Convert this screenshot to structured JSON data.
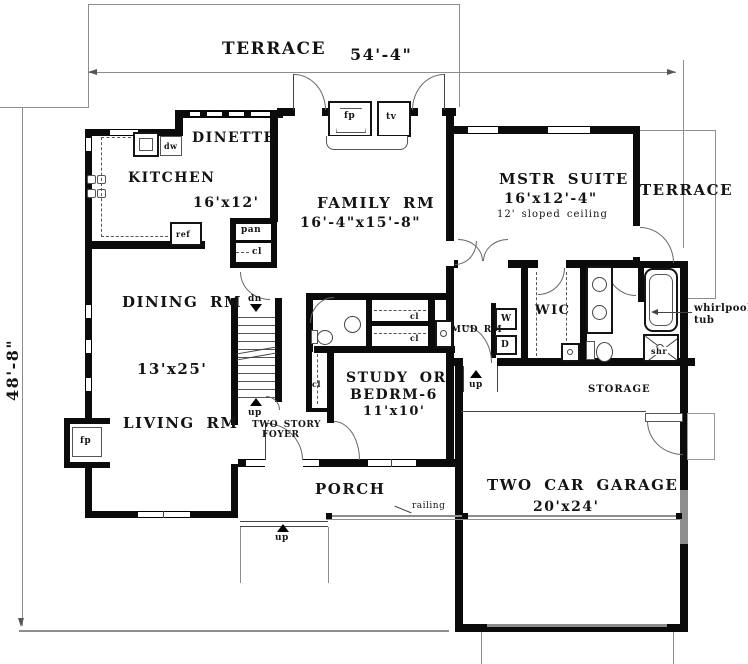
{
  "plan": {
    "dimensions": {
      "width": "54'-4\"",
      "height": "48'-8\""
    },
    "outdoor": {
      "terrace_top": "TERRACE",
      "terrace_right": "TERRACE",
      "porch": "PORCH",
      "railing": "railing",
      "storage": "STORAGE"
    },
    "rooms": {
      "dinette": {
        "name": "DINETTE"
      },
      "kitchen": {
        "name": "KITCHEN",
        "size": "16'x12'"
      },
      "family": {
        "name": "FAMILY RM",
        "size": "16'-4\"x15'-8\""
      },
      "master": {
        "name": "MSTR SUITE",
        "size": "16'x12'-4\"",
        "note": "12' sloped ceiling"
      },
      "dining": {
        "name": "DINING RM",
        "size": "13'x25'"
      },
      "living": {
        "name": "LIVING RM"
      },
      "study": {
        "line1": "STUDY OR",
        "line2": "BEDRM-6",
        "size": "11'x10'"
      },
      "garage": {
        "name": "TWO CAR GARAGE",
        "size": "20'x24'"
      },
      "foyer": {
        "line1": "TWO STORY",
        "line2": "FOYER"
      },
      "wic": {
        "name": "WIC"
      },
      "mud": {
        "name": "MUD RM"
      }
    },
    "fixtures": {
      "fireplace": "fp",
      "tv": "tv",
      "dishwasher": "dw",
      "refrigerator": "ref",
      "pantry": "pan",
      "closet": "cl",
      "washer": "W",
      "dryer": "D",
      "shower": "shr",
      "whirlpool_line1": "whirlpool",
      "whirlpool_line2": "tub",
      "down": "dn",
      "up": "up"
    },
    "colors": {
      "wall": "#0b0b0b",
      "thin_line": "#8d8d8d",
      "background": "#ffffff"
    }
  }
}
